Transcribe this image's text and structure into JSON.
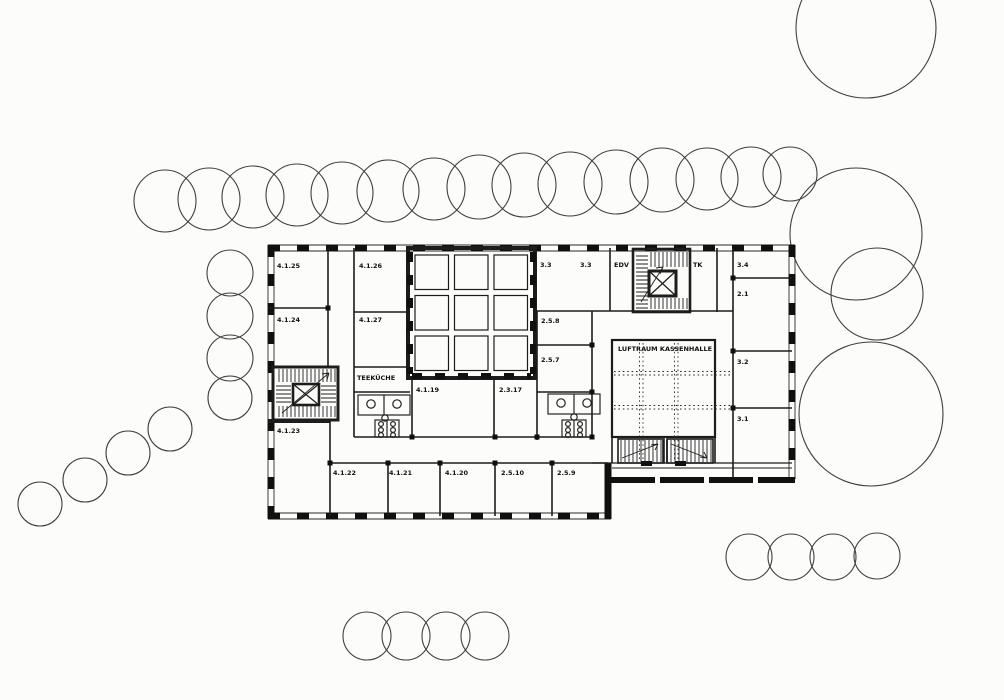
{
  "drawing": {
    "kind": "architectural floor plan (scanned)",
    "paper_color": "#fcfcfa",
    "ink_color": "#1c1c1c"
  },
  "labels": {
    "room_4_1_25": "4.1.25",
    "room_4_1_26": "4.1.26",
    "room_4_1_24": "4.1.24",
    "room_4_1_27": "4.1.27",
    "teekueche": "TEEKÜCHE",
    "room_4_1_23": "4.1.23",
    "room_4_1_19": "4.1.19",
    "room_2_3_17": "2.3.17",
    "room_3_3_a": "3.3",
    "room_3_3_b": "3.3",
    "edv": "EDV",
    "tk": "TK",
    "room_3_4": "3.4",
    "room_2_1": "2.1",
    "room_3_2": "3.2",
    "room_3_1": "3.1",
    "room_2_5_8": "2.5.8",
    "room_2_5_7": "2.5.7",
    "luftraum_kassenhalle": "LUFTRAUM KASSENHALLE",
    "room_4_1_22": "4.1.22",
    "room_4_1_21": "4.1.21",
    "room_4_1_20": "4.1.20",
    "room_2_5_10": "2.5.10",
    "room_2_5_9": "2.5.9"
  },
  "site": {
    "trees": [
      {
        "cx": 165,
        "cy": 201,
        "r": 31
      },
      {
        "cx": 209,
        "cy": 199,
        "r": 31
      },
      {
        "cx": 253,
        "cy": 197,
        "r": 31
      },
      {
        "cx": 297,
        "cy": 195,
        "r": 31
      },
      {
        "cx": 342,
        "cy": 193,
        "r": 31
      },
      {
        "cx": 388,
        "cy": 191,
        "r": 31
      },
      {
        "cx": 434,
        "cy": 189,
        "r": 31
      },
      {
        "cx": 479,
        "cy": 187,
        "r": 32
      },
      {
        "cx": 524,
        "cy": 185,
        "r": 32
      },
      {
        "cx": 570,
        "cy": 184,
        "r": 32
      },
      {
        "cx": 616,
        "cy": 182,
        "r": 32
      },
      {
        "cx": 662,
        "cy": 180,
        "r": 32
      },
      {
        "cx": 707,
        "cy": 179,
        "r": 31
      },
      {
        "cx": 751,
        "cy": 177,
        "r": 30
      },
      {
        "cx": 790,
        "cy": 174,
        "r": 27
      },
      {
        "cx": 230,
        "cy": 273,
        "r": 23
      },
      {
        "cx": 230,
        "cy": 316,
        "r": 23
      },
      {
        "cx": 230,
        "cy": 358,
        "r": 23
      },
      {
        "cx": 230,
        "cy": 398,
        "r": 22
      },
      {
        "cx": 40,
        "cy": 504,
        "r": 22
      },
      {
        "cx": 85,
        "cy": 480,
        "r": 22
      },
      {
        "cx": 128,
        "cy": 453,
        "r": 22
      },
      {
        "cx": 170,
        "cy": 429,
        "r": 22
      },
      {
        "cx": 866,
        "cy": 28,
        "r": 70
      },
      {
        "cx": 856,
        "cy": 234,
        "r": 66
      },
      {
        "cx": 877,
        "cy": 294,
        "r": 46
      },
      {
        "cx": 871,
        "cy": 414,
        "r": 72
      },
      {
        "cx": 749,
        "cy": 557,
        "r": 23
      },
      {
        "cx": 791,
        "cy": 557,
        "r": 23
      },
      {
        "cx": 833,
        "cy": 557,
        "r": 23
      },
      {
        "cx": 877,
        "cy": 556,
        "r": 23
      },
      {
        "cx": 367,
        "cy": 636,
        "r": 24
      },
      {
        "cx": 406,
        "cy": 636,
        "r": 24
      },
      {
        "cx": 446,
        "cy": 636,
        "r": 24
      },
      {
        "cx": 485,
        "cy": 636,
        "r": 24
      }
    ]
  }
}
